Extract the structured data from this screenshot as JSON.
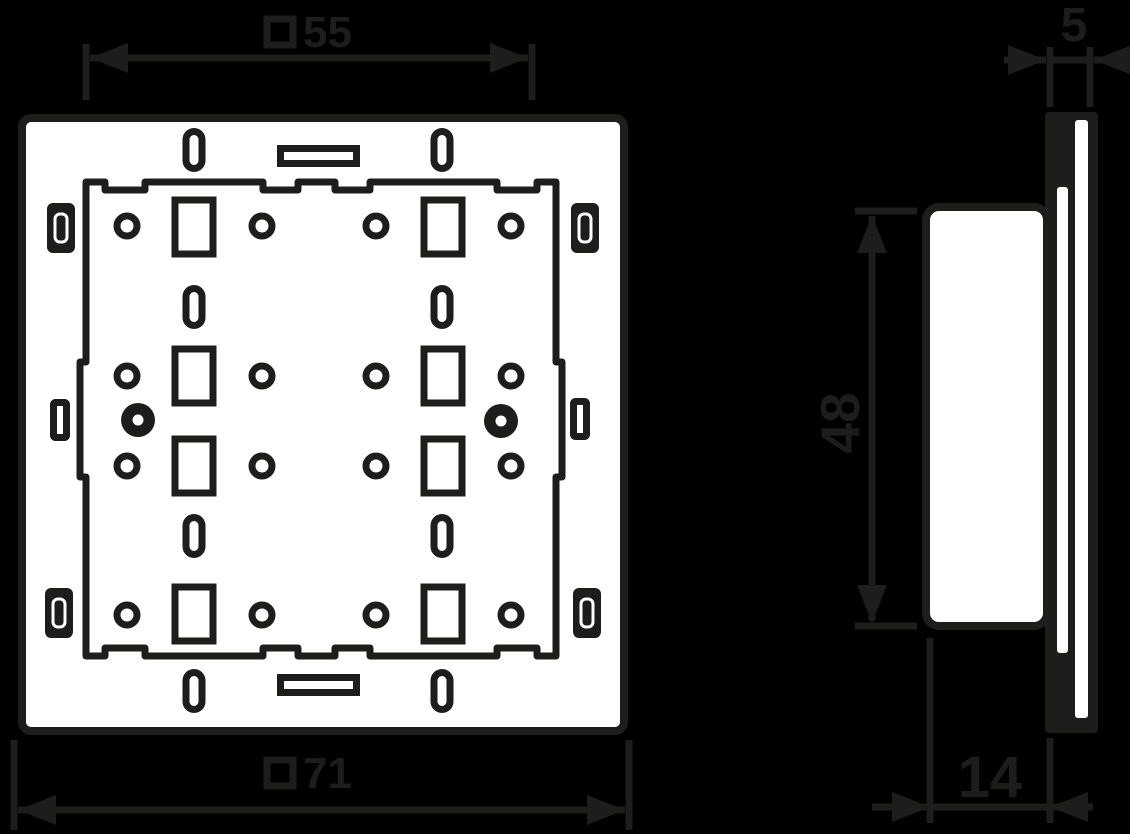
{
  "colors": {
    "background": "#000000",
    "line": "#1d1d1b",
    "fill": "#ffffff"
  },
  "dimensions": {
    "front_inner_width": {
      "symbol": "□",
      "value": "55"
    },
    "front_outer_width": {
      "symbol": "□",
      "value": "71"
    },
    "side_frame_thickness": {
      "value": "5"
    },
    "side_body_height": {
      "value": "48"
    },
    "side_body_depth": {
      "value": "14"
    }
  }
}
